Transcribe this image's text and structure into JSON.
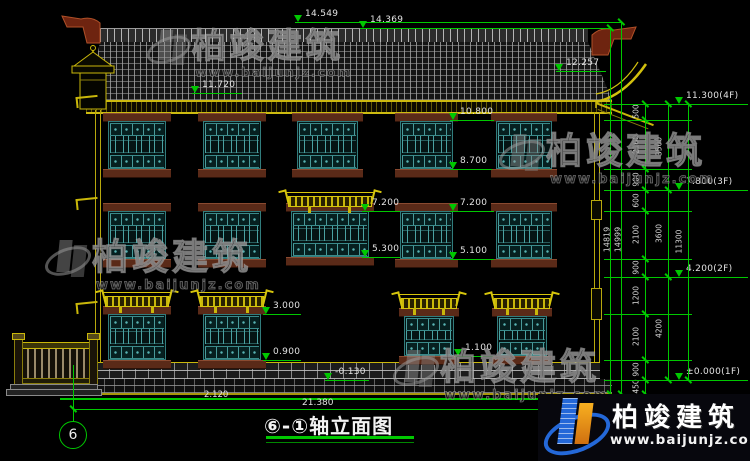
{
  "drawing": {
    "title": "⑥-①轴立面图",
    "axis_bubble": "6",
    "bottom_total_dim": "21.380",
    "bottom_left_dim": "2.120",
    "colors": {
      "annotation_green": "#00c800",
      "building_yellow": "#c9b70a",
      "window_teal": "#4aa2a2",
      "ornament_red": "#8a3318",
      "logo_blue": "#2468d8",
      "logo_orange": "#f8b020"
    }
  },
  "brand": {
    "name": "柏竣建筑",
    "url": "www.baijunjz.com"
  },
  "annotations": {
    "level_flags": [
      {
        "label": "14.549",
        "x": 295,
        "y": 22,
        "lw": 58
      },
      {
        "label": "14.369",
        "x": 360,
        "y": 28,
        "lw": 55
      },
      {
        "label": "12.257",
        "x": 556,
        "y": 71,
        "lw": 50
      },
      {
        "label": "11.720",
        "x": 192,
        "y": 93,
        "lw": 50
      },
      {
        "label": "10.800",
        "x": 450,
        "y": 120,
        "lw": 44
      },
      {
        "label": "8.700",
        "x": 450,
        "y": 169,
        "lw": 42
      },
      {
        "label": "7.200",
        "x": 362,
        "y": 211,
        "lw": 38
      },
      {
        "label": "5.300",
        "x": 362,
        "y": 257,
        "lw": 38
      },
      {
        "label": "7.200",
        "x": 450,
        "y": 211,
        "lw": 44
      },
      {
        "label": "5.100",
        "x": 450,
        "y": 259,
        "lw": 44
      },
      {
        "label": "3.000",
        "x": 263,
        "y": 314,
        "lw": 38
      },
      {
        "label": "0.900",
        "x": 263,
        "y": 360,
        "lw": 38
      },
      {
        "label": "1.100",
        "x": 455,
        "y": 356,
        "lw": 38
      },
      {
        "label": "-0.130",
        "x": 325,
        "y": 380,
        "lw": 44
      },
      {
        "label": "11.300(4F)",
        "x": 676,
        "y": 104,
        "lw": 72
      },
      {
        "label": "7.800(3F)",
        "x": 676,
        "y": 190,
        "lw": 72
      },
      {
        "label": "4.200(2F)",
        "x": 676,
        "y": 277,
        "lw": 72
      },
      {
        "label": "±0.000(1F)",
        "x": 676,
        "y": 380,
        "lw": 72
      }
    ],
    "chain_tiers": [
      {
        "x": 645,
        "bounds": [
          104,
          120,
          169,
          190,
          211,
          259,
          277,
          314,
          360,
          380,
          394
        ],
        "labels": [
          "500",
          "2100",
          "900",
          "600",
          "2100",
          "900",
          "1200",
          "2100",
          "900",
          "450"
        ]
      },
      {
        "x": 668,
        "bounds": [
          104,
          190,
          277,
          380
        ],
        "labels": [
          "3500",
          "3600",
          "4200"
        ]
      },
      {
        "x": 688,
        "bounds": [
          104,
          380
        ],
        "labels": [
          "11300"
        ]
      }
    ],
    "tall_dims": [
      {
        "label": "14819",
        "x": 610,
        "y1": 28,
        "y2": 394
      },
      {
        "label": "14999",
        "x": 621,
        "y1": 22,
        "y2": 394
      }
    ]
  }
}
